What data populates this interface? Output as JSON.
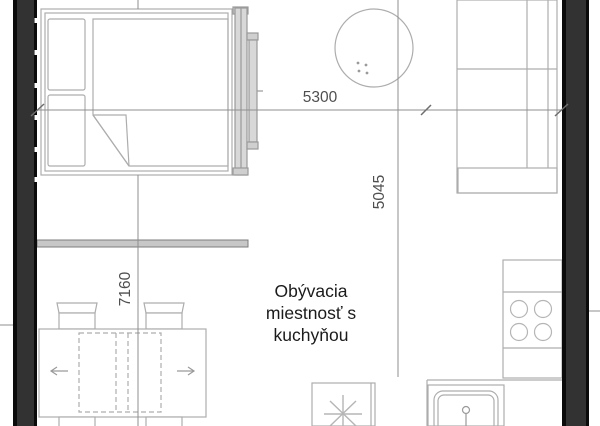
{
  "floorplan": {
    "room_label": {
      "line1": "Obývacia",
      "line2": "miestnosť s",
      "line3": "kuchyňou"
    },
    "dimensions": {
      "top_width": "5300",
      "right_height": "5045",
      "left_height": "7160"
    },
    "elements": {
      "bed": "double bed with two pillows and folded blanket",
      "round_table": "round table",
      "sofa": "sofa along right wall",
      "tv_board": "wall-mounted board/shelf",
      "dining_table": "extendable dining table with arrows and 4 chairs",
      "kitchen_counter": "kitchen counter along right wall",
      "stove": "cooktop with 4 burners",
      "sink": "kitchen sink with faucet",
      "appliance": "appliance square with asterisk symbol"
    },
    "colors": {
      "wall_fill": "#323232",
      "wall_edge": "#0b0b0b",
      "furniture_line": "#adadad",
      "gray_fill": "#c7c7c7",
      "dimension_line": "#8f8f8f",
      "dimension_text": "#4f4f4f",
      "room_text": "#1b1b1b",
      "background": "#ffffff"
    }
  }
}
